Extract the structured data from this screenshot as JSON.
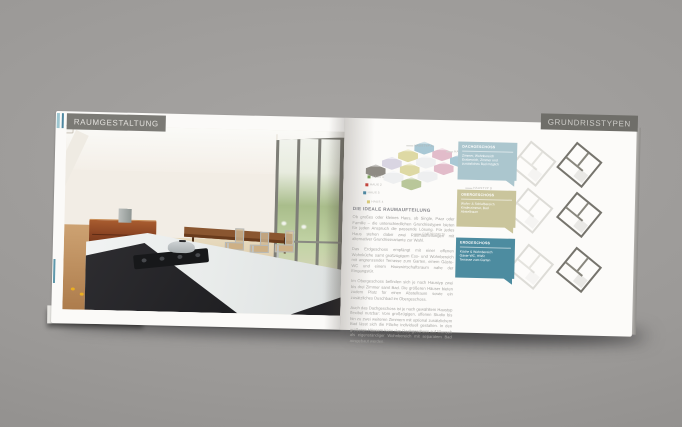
{
  "surface": {
    "background_gray": "#9b9997"
  },
  "left_page": {
    "header": {
      "label": "RAUMGESTALTUNG",
      "badge_color": "#7b7a75",
      "text_color": "#e3e1dd",
      "stripes": [
        "#9ec7d1",
        "#4e87a0"
      ]
    },
    "photo_alt": "offene-wohnkueche-mit-essbereich",
    "edge_accent_color": "#5f98ab"
  },
  "right_page": {
    "header": {
      "label": "GRUNDRISSTYPEN",
      "badge_color": "#6f6e69",
      "text_color": "#cdccc8"
    },
    "site_diagram": {
      "houses": [
        {
          "x": 52,
          "y": 2,
          "color": "#a9c8d5"
        },
        {
          "x": 70,
          "y": 8,
          "color": "#e2bcca"
        },
        {
          "x": 88,
          "y": 14,
          "color": "#a9c8d5"
        },
        {
          "x": 36,
          "y": 10,
          "color": "#ded9a4"
        },
        {
          "x": 54,
          "y": 16,
          "color": "#eeeff0"
        },
        {
          "x": 72,
          "y": 22,
          "color": "#e2bcca"
        },
        {
          "x": 20,
          "y": 18,
          "color": "#d9d5e2"
        },
        {
          "x": 38,
          "y": 24,
          "color": "#ded9a4"
        },
        {
          "x": 56,
          "y": 30,
          "color": "#eeeff0"
        },
        {
          "x": 4,
          "y": 26,
          "color": "#8f8b84"
        },
        {
          "x": 22,
          "y": 32,
          "color": "#eeeff0"
        },
        {
          "x": 40,
          "y": 38,
          "color": "#b9c79a"
        }
      ],
      "labels": [
        {
          "text": "HAUSTYP A",
          "x": 44,
          "y": 4
        },
        {
          "text": "HAUSTYP B",
          "x": 84,
          "y": 9
        },
        {
          "text": "HAUSTYP C",
          "x": 100,
          "y": 34
        },
        {
          "text": "HAUSTYP D",
          "x": 104,
          "y": 45
        },
        {
          "text": "HAUSTYP E",
          "x": 107,
          "y": 56
        },
        {
          "text": "GARTENSEITE",
          "x": 54,
          "y": 92
        },
        {
          "text": "HAUS 1",
          "x": 6,
          "y": 36,
          "dot": "#7ba05b"
        },
        {
          "text": "HAUS 2",
          "x": 4,
          "y": 44,
          "dot": "#c2453e"
        },
        {
          "text": "HAUS 3",
          "x": 2,
          "y": 52,
          "dot": "#4e87a0"
        },
        {
          "text": "HAUS 4",
          "x": 6,
          "y": 61,
          "dot": "#d8c97a"
        }
      ]
    },
    "floor_boxes": [
      {
        "title": "DACHGESCHOSS",
        "lines": [
          "Zimmer, Wohnbereich",
          "Essbereich, Zimmer und",
          "zusätzliches Bad möglich"
        ],
        "color": "#abc6ce",
        "top": 21,
        "height": 38
      },
      {
        "title": "OBERGESCHOSS",
        "lines": [
          "Wohn- & Schlafbereich",
          "Kinderzimmer, Bad",
          "Abstellraum"
        ],
        "color": "#cac59c",
        "top": 69,
        "height": 37
      },
      {
        "title": "ERDGESCHOSS",
        "lines": [
          "Küche & Wohnbereich",
          "Gäste-WC, HWR",
          "Terrasse zum Garten"
        ],
        "color": "#4d8ca0",
        "top": 117,
        "height": 40
      }
    ],
    "plans": [
      {
        "row": 0,
        "variant": "light"
      },
      {
        "row": 0,
        "variant": "dark"
      },
      {
        "row": 1,
        "variant": "light"
      },
      {
        "row": 1,
        "variant": "dark"
      },
      {
        "row": 2,
        "variant": "light"
      },
      {
        "row": 2,
        "variant": "dark"
      }
    ],
    "article": {
      "heading": "DIE IDEALE RAUMAUFTEILUNG",
      "paragraphs": [
        "Ob großes oder kleines Haus, ob Single, Paar oder Familie – die unterschiedlichen Grundrisstypen bieten für jeden Anspruch die passende Lösung. Für jedes Haus stehen dabei zwei Raumaufteilungen mit alternativer Grundrissvariante zur Wahl.",
        "Das Erdgeschoss empfängt mit einer offenen Wohnküche samt großzügigem Ess- und Wohnbereich mit angrenzender Terrasse zum Garten, einem Gäste-WC und einem Hauswirtschaftsraum nahe der Eingangstür.",
        "Im Obergeschoss befinden sich je nach Haustyp zwei bis drei Zimmer samt Bad. Die größeren Häuser bieten zudem Platz für einen Abstellraum sowie ein zusätzliches Duschbad im Obergeschoss.",
        "Auch das Dachgeschoss ist je nach gewähltem Haustyp flexibel nutzbar: Vom großzügigen, offenen Studio bis hin zu zwei weiteren Zimmern mit optional zusätzlichem Bad lässt sich die Fläche individuell gestalten. In den größeren Häusern kann das Dachgeschoss auf Wunsch als eigenständiger Wohnbereich mit separatem Bad ausgebaut werden."
      ]
    }
  }
}
